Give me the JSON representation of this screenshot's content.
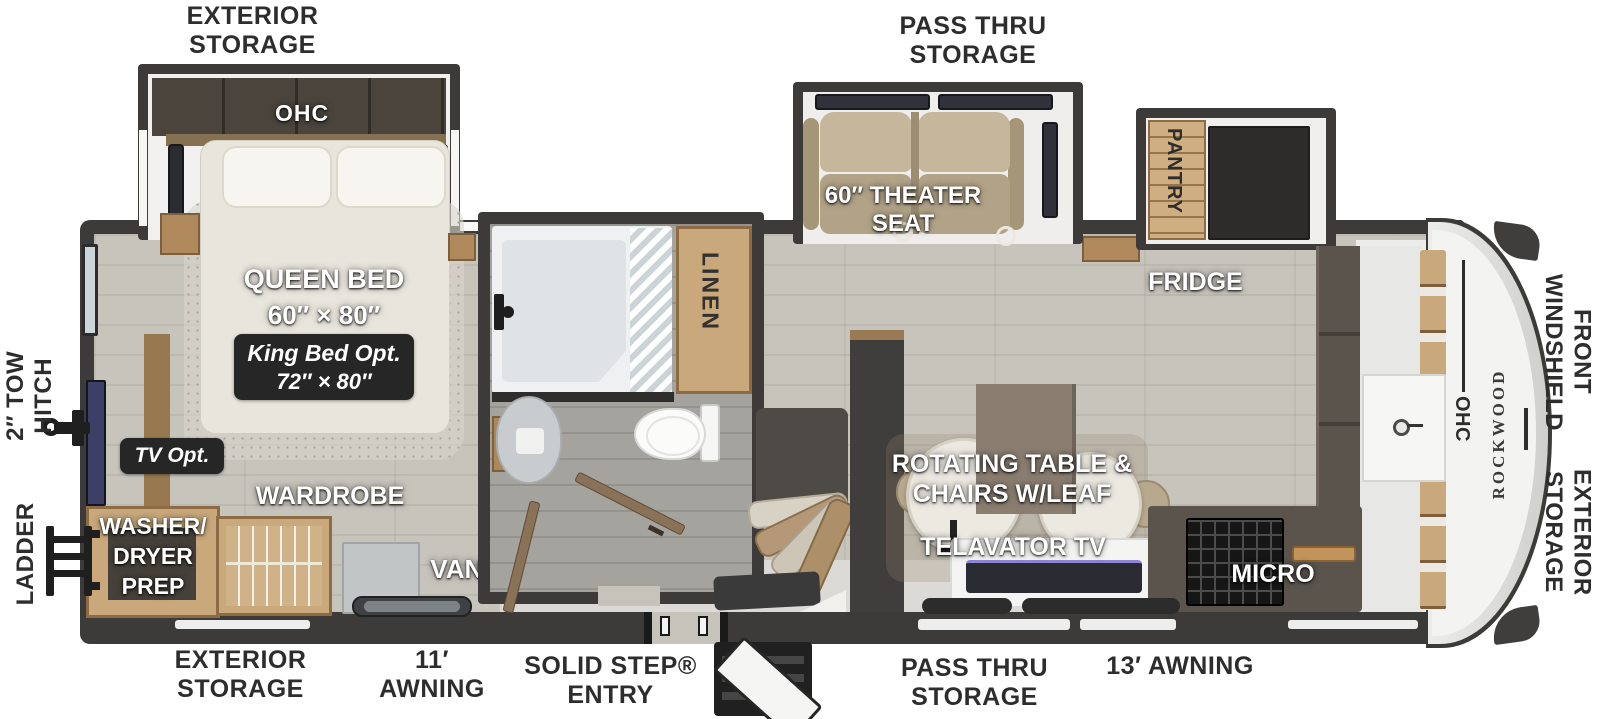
{
  "colors": {
    "wall_dark": "#3c3b39",
    "floor_gray_wood": "#c7c4bc",
    "bath_floor": "#a4a39e",
    "wood_cabinet": "#c9a87c",
    "wood_edge": "#8d6c45",
    "theater_seat_tan": "#b7a88e",
    "badge_dark": "#262626",
    "label_white": "#ffffff",
    "label_black": "#2d2d2d",
    "rear_tv_screen": "#3c3f66",
    "front_cap_gray": "#d7d7d5"
  },
  "exterior": {
    "top_storage": {
      "l1": "EXTERIOR",
      "l2": "STORAGE"
    },
    "top_pass": {
      "l1": "PASS THRU",
      "l2": "STORAGE"
    },
    "windshield": {
      "l1": "FRONT",
      "l2": "WINDSHIELD"
    },
    "front_storage": {
      "l1": "EXTERIOR",
      "l2": "STORAGE"
    },
    "hitch": {
      "l1": "2″ TOW",
      "l2": "HITCH"
    },
    "ladder": "LADDER",
    "bottom_storage": {
      "l1": "EXTERIOR",
      "l2": "STORAGE"
    },
    "awning11": {
      "l1": "11′",
      "l2": "AWNING"
    },
    "entry": {
      "l1": "SOLID STEP®",
      "l2": "ENTRY"
    },
    "bottom_pass": {
      "l1": "PASS THRU",
      "l2": "STORAGE"
    },
    "awning13": "13′ AWNING"
  },
  "bedroom": {
    "ohc": "OHC",
    "bed": {
      "title": "QUEEN BED",
      "size": "60″ × 80″"
    },
    "king_opt": {
      "l1": "King Bed Opt.",
      "l2": "72″ × 80″"
    },
    "tv_opt": "TV Opt.",
    "wardrobe": "WARDROBE",
    "washer": {
      "l1": "WASHER/",
      "l2": "DRYER",
      "l3": "PREP"
    },
    "vanity": "VANITY"
  },
  "bathroom": {
    "linen": "LINEN"
  },
  "living": {
    "theater": {
      "l1": "60″ THEATER",
      "l2": "SEAT"
    },
    "pantry": "PANTRY",
    "fridge": "FRIDGE",
    "dinette": {
      "l1": "ROTATING TABLE &",
      "l2": "CHAIRS W/LEAF"
    },
    "tv": "TELAVATOR TV",
    "micro": "MICRO",
    "kitchen_ohc": "OHC"
  },
  "brand": "ROCKWOOD"
}
